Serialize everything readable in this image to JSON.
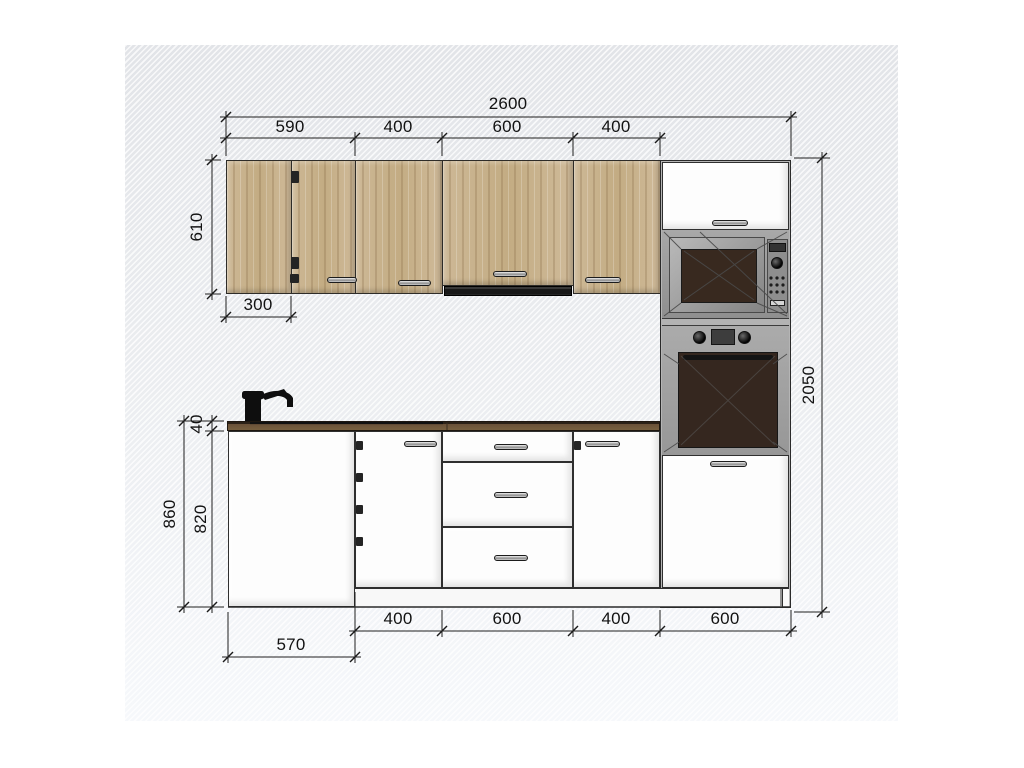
{
  "drawing": {
    "type": "kitchen-elevation-dimension-drawing",
    "dims": {
      "total_width": "2600",
      "upper_segments": [
        "590",
        "400",
        "600",
        "400"
      ],
      "upper_height": "610",
      "corner_panel_width": "300",
      "worktop_thickness": "40",
      "base_total_height": "860",
      "base_cabinet_height": "820",
      "total_height": "2050",
      "base_segments": [
        "400",
        "600",
        "400",
        "600"
      ],
      "side_depth": "570"
    },
    "colors": {
      "wood_front": "#c9b28b",
      "worktop": "#6a5138",
      "appliance_gray": "#a0a0a0",
      "oven_door": "#35271f",
      "hood": "#181818",
      "dimension_line": "#1f1f1f"
    }
  }
}
